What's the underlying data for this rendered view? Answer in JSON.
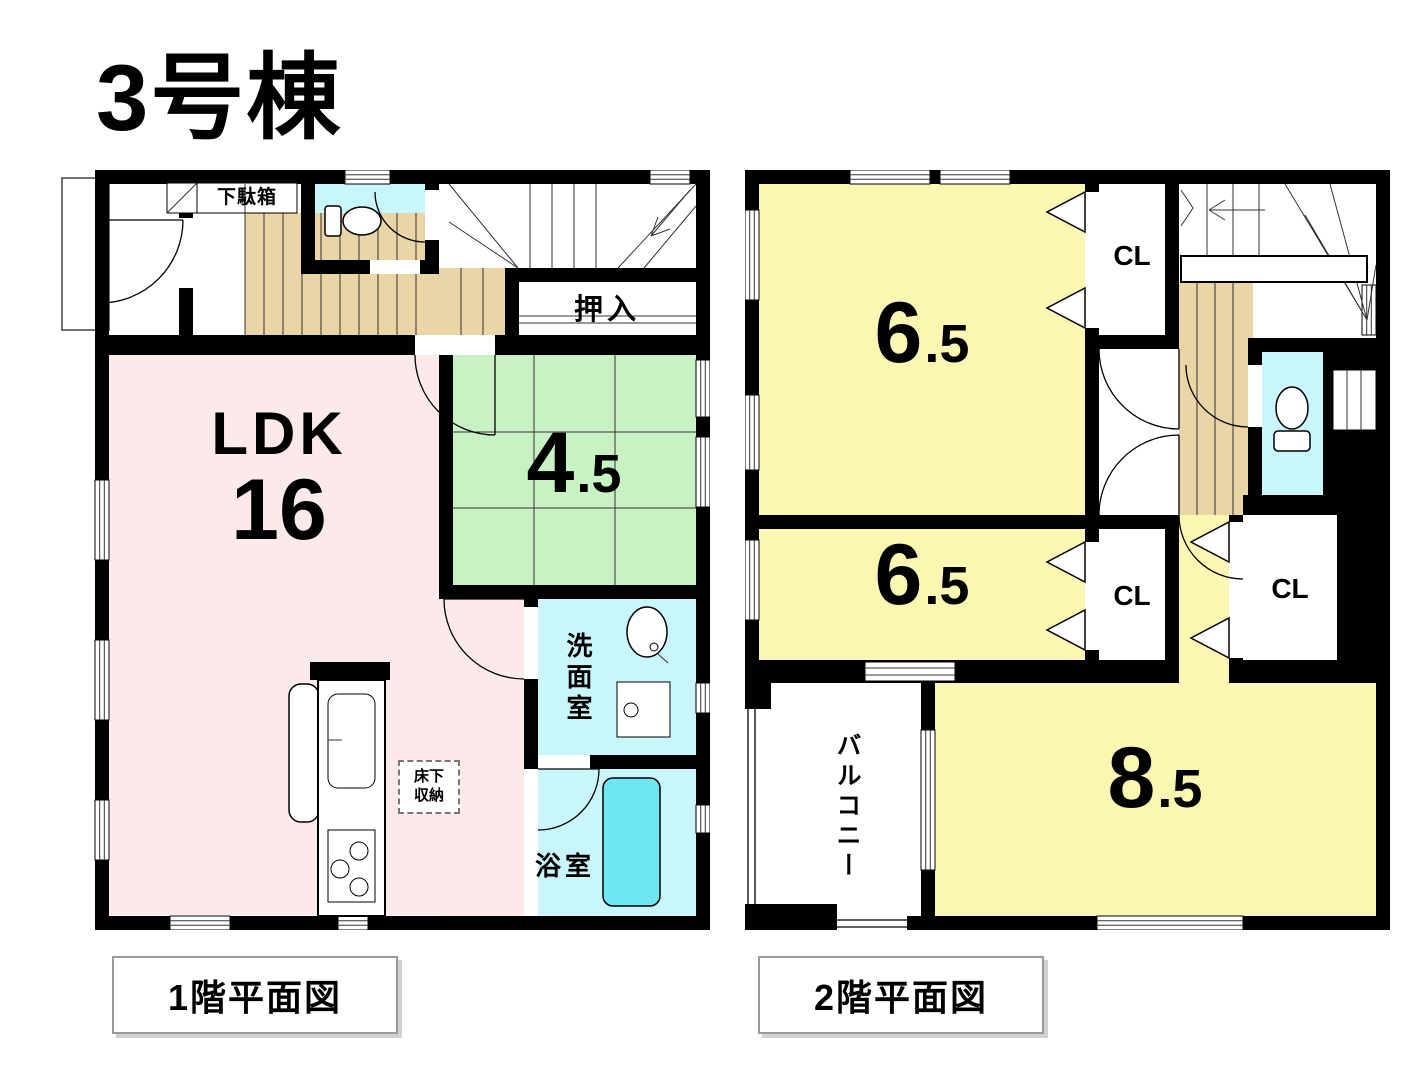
{
  "title": "3号棟",
  "colors": {
    "wall": "#000000",
    "ldk_pink": "#fce9e9",
    "tatami_green": "#c9f2c4",
    "room_yellow": "#fbf7b2",
    "water_cyan": "#c9f6fb",
    "bathtub_cyan": "#6ee7f2",
    "floor_tan": "#e9d5a5"
  },
  "floor1": {
    "caption": "1階平面図",
    "rooms": {
      "ldk_name": "LDK",
      "ldk_size": "16",
      "tatami_size_main": "4",
      "tatami_size_dec": ".5",
      "oshiire": "押入",
      "getabako": "下駄箱",
      "senmenshitsu": "洗面室",
      "yokushitsu": "浴室",
      "yukashita_1": "床下",
      "yukashita_2": "収納"
    }
  },
  "floor2": {
    "caption": "2階平面図",
    "rooms": {
      "bedroom1_main": "6",
      "bedroom1_dec": ".5",
      "bedroom2_main": "6",
      "bedroom2_dec": ".5",
      "bedroom3_main": "8",
      "bedroom3_dec": ".5",
      "closet1": "CL",
      "closet2": "CL",
      "closet3": "CL",
      "balcony": "バルコニー"
    }
  }
}
